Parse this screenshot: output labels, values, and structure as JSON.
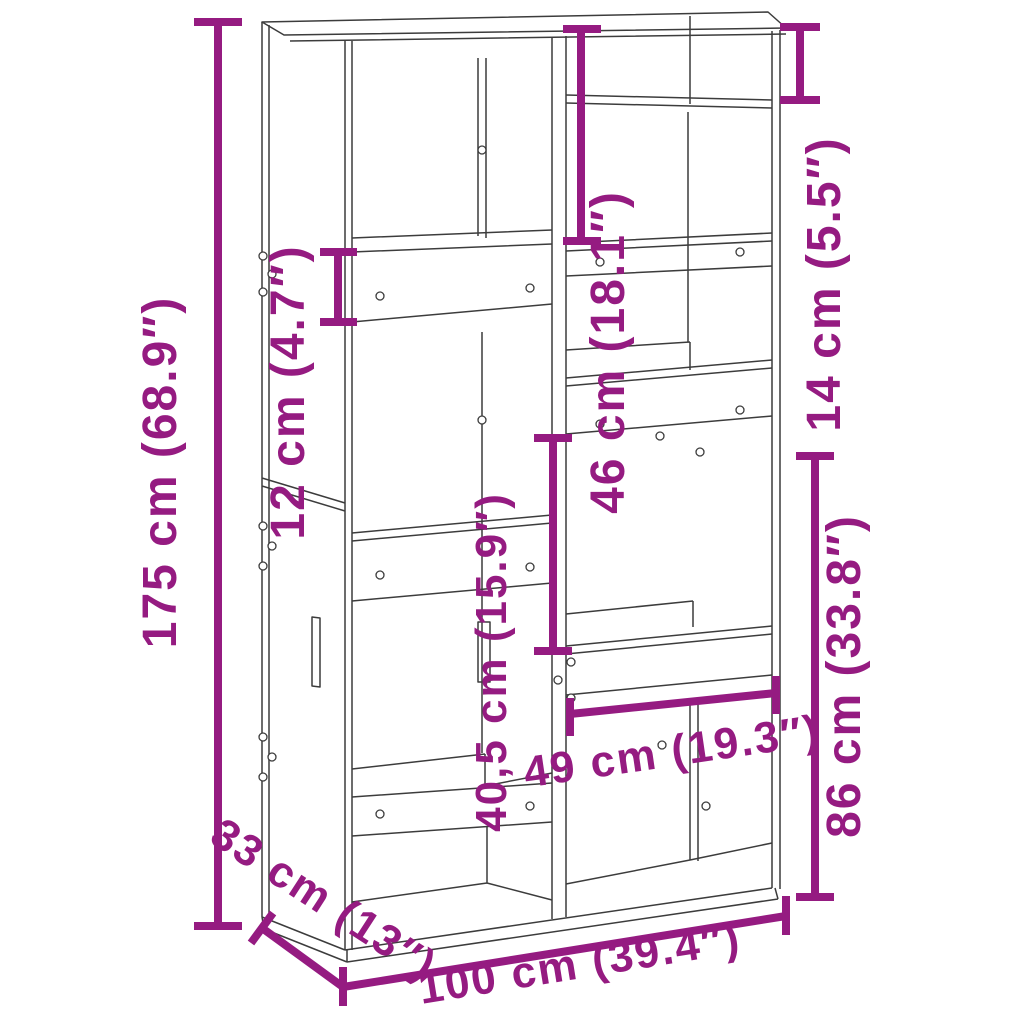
{
  "diagram": {
    "kind": "furniture-dimension-diagram",
    "subject": "bookcase-room-divider"
  },
  "colors": {
    "accent": "#951B81",
    "line": "#3C3C3C",
    "background": "#FFFFFF"
  },
  "dimensions": {
    "height_total": {
      "label": "175 cm (68.9″)",
      "value_cm": "175",
      "value_in": "68.9"
    },
    "shelf_band": {
      "label": "12 cm (4.7″)",
      "value_cm": "12",
      "value_in": "4.7"
    },
    "top_section": {
      "label": "46 cm (18.1″)",
      "value_cm": "46",
      "value_in": "18.1"
    },
    "top_right_slot": {
      "label": "14 cm (5.5″)",
      "value_cm": "14",
      "value_in": "5.5"
    },
    "middle_opening": {
      "label": "40,5 cm (15.9″)",
      "value_cm": "40,5",
      "value_in": "15.9"
    },
    "lower_right_section": {
      "label": "86 cm (33.8″)",
      "value_cm": "86",
      "value_in": "33.8"
    },
    "inner_width": {
      "label": "49 cm (19.3″)",
      "value_cm": "49",
      "value_in": "19.3"
    },
    "depth": {
      "label": "33 cm (13″)",
      "value_cm": "33",
      "value_in": "13"
    },
    "width_total": {
      "label": "100 cm (39.4″)",
      "value_cm": "100",
      "value_in": "39.4"
    }
  }
}
